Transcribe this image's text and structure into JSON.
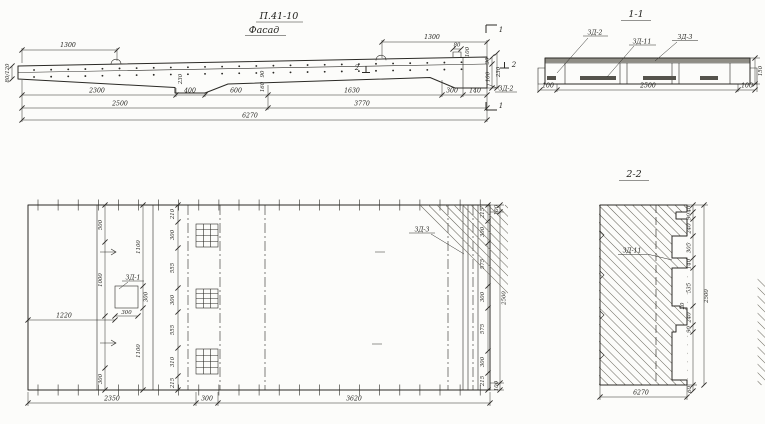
{
  "title": {
    "code": "П.41-10",
    "view": "Фасад"
  },
  "elevation": {
    "top_dim_left": "1300",
    "top_dim_right": "1300",
    "tab_width": "80",
    "tab_height": "100",
    "left_end_dims": "80/120",
    "web_depth": "230",
    "step_90": "90",
    "step_160": "160",
    "end_30": "30",
    "end_100": "100",
    "end_230": "230",
    "detail_label": "ЗД-2",
    "mark1": "1",
    "mark2": "2",
    "row1": [
      "2300",
      "400",
      "600",
      "1630",
      "300",
      "140"
    ],
    "row2": [
      "2500",
      "3770"
    ],
    "total": "6270"
  },
  "section11": {
    "title": "1-1",
    "labels": {
      "zd2": "ЗД-2",
      "zd11": "ЗД-11",
      "zd3": "ЗД-3"
    },
    "dims": {
      "left": "100",
      "span": "2500",
      "right": "100",
      "height": "150"
    }
  },
  "plan": {
    "labels": {
      "zd1": "ЗД-1",
      "zd3": "ЗД-3"
    },
    "left_chain": [
      "500",
      "1000",
      "300"
    ],
    "mid_chain": [
      "1100",
      "300",
      "1100"
    ],
    "offset": "1220",
    "square": {
      "w": "300",
      "h": "300"
    },
    "mesh_chain": [
      "210",
      "300",
      "555",
      "300",
      "555",
      "310",
      "215"
    ],
    "right_chain": [
      "215",
      "300",
      "575",
      "300",
      "575",
      "300",
      "215"
    ],
    "outer_chain": [
      "100",
      "2500",
      "100"
    ],
    "bottom": [
      "2350",
      "300",
      "3620"
    ]
  },
  "section22": {
    "title": "2-2",
    "label": "ЗД-11",
    "chain": [
      "40",
      "90",
      "240",
      "305",
      "140",
      "535",
      "20",
      "240",
      "90"
    ],
    "total": "2500",
    "bottom_offset": "60",
    "length": "6270"
  }
}
